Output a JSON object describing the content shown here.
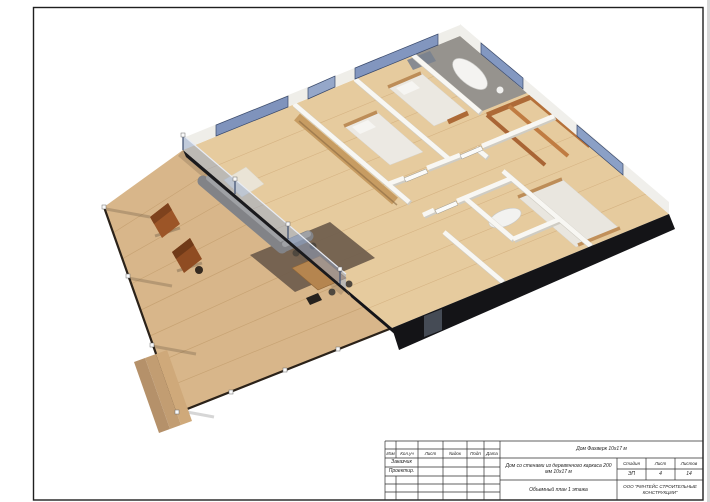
{
  "title_block": {
    "columns": [
      "Изм",
      "Кол.уч",
      "Лист",
      "№док",
      "Подп",
      "Дата"
    ],
    "rows": [
      {
        "label": "Заказчик"
      },
      {
        "label": "Проектир."
      }
    ],
    "project_title": "Дом Фахверк 10х17 м",
    "object_description": "Дом со стенами из деревянного каркаса 200 мм 10х17 м",
    "drawing_title": "Объемный план 1 этажа",
    "stage": {
      "label": "Стадия",
      "value": "ЭП"
    },
    "sheet_num": {
      "label": "Лист",
      "value": "4"
    },
    "sheet_total": {
      "label": "Листов",
      "value": "14"
    },
    "company": "ООО \"РИНТЕЙС СТРОИТЕЛЬНЫЕ КОНСТРУКЦИИ\""
  },
  "render": {
    "colors": {
      "deck_wood": "#d8b68a",
      "floor_wood": "#e6cb9e",
      "facade_dark": "#141417",
      "glass_blue": "#8ea5cd",
      "wall_white": "#f8f7f3",
      "sofa_gray": "#8a8b8f",
      "closet_wood": "#b5713a",
      "rug_brown": "#6e5c4c",
      "lounge_chair": "#9c5527"
    }
  }
}
